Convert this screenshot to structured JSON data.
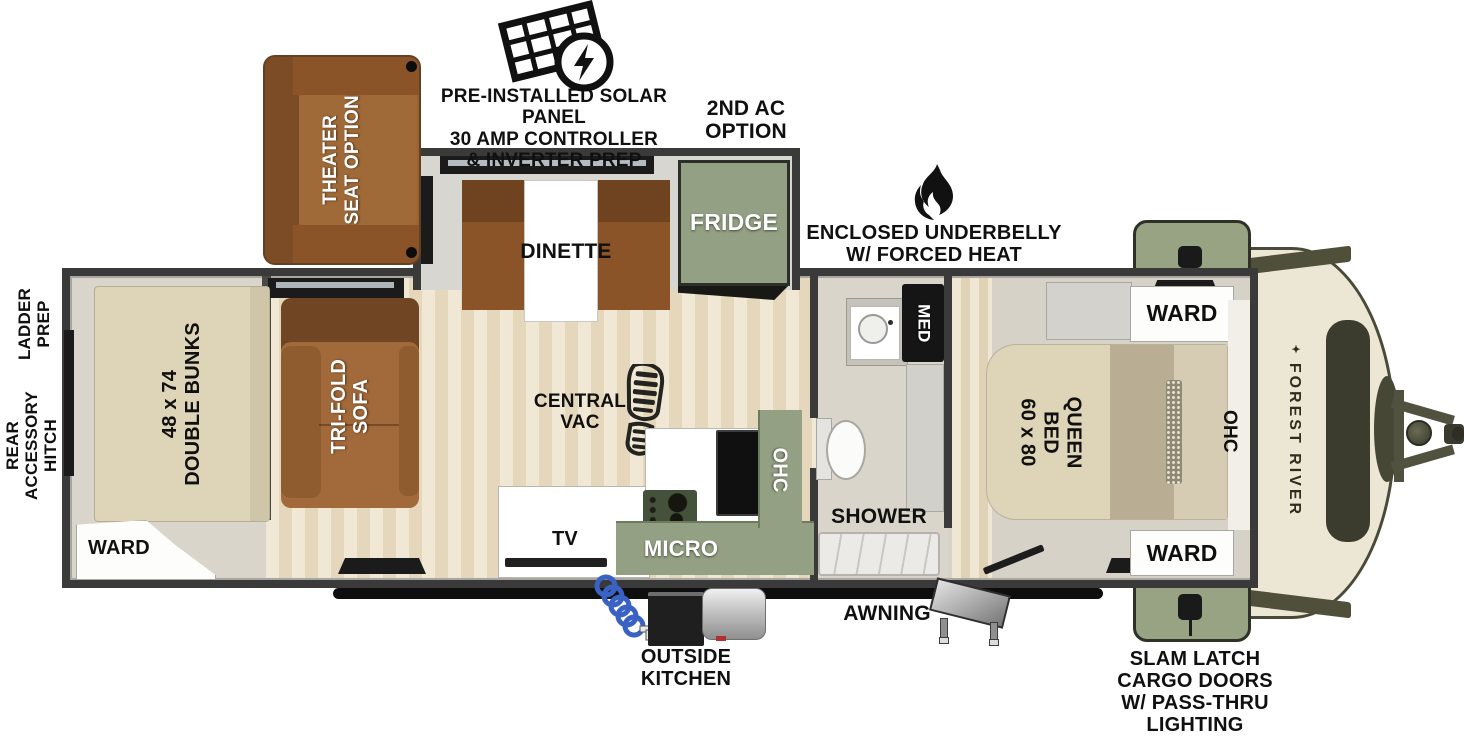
{
  "meta": {
    "title": "Travel trailer floorplan",
    "width": 1464,
    "height": 738
  },
  "colors": {
    "wall": "#3a3a3a",
    "sage_green": "#93a083",
    "sage_dark": "#45523b",
    "sofa_brown": "#a0683a",
    "sofa_dark": "#6f4523",
    "bed_beige": "#ded4b7",
    "bed_olive": "#b9ae93",
    "floor_wood": "#ebdfc4",
    "front_cap_cream": "#ece7d4",
    "olive_trim": "#50503a",
    "hose_blue": "#3a62c4"
  },
  "callouts": {
    "solar": {
      "icon": "solar-panel-icon",
      "lines": [
        "PRE-INSTALLED SOLAR PANEL",
        "30 AMP CONTROLLER",
        "& INVERTER PREP"
      ]
    },
    "second_ac": {
      "lines": [
        "2ND AC",
        "OPTION"
      ]
    },
    "underbelly": {
      "icon": "flame-icon",
      "lines": [
        "ENCLOSED UNDERBELLY",
        "W/ FORCED HEAT"
      ]
    },
    "ladder_prep": {
      "lines": [
        "LADDER",
        "PREP"
      ]
    },
    "rear_accessory_hitch": {
      "lines": [
        "REAR",
        "ACCESSORY",
        "HITCH"
      ]
    },
    "awning": {
      "label": "AWNING"
    },
    "outside_kitchen": {
      "lines": [
        "OUTSIDE",
        "KITCHEN"
      ]
    },
    "slam_latch": {
      "lines": [
        "SLAM LATCH",
        "CARGO DOORS",
        "W/ PASS-THRU",
        "LIGHTING"
      ]
    }
  },
  "options": {
    "theater_seat": {
      "lines": [
        "THEATER",
        "SEAT OPTION"
      ]
    }
  },
  "rooms": {
    "dinette": {
      "label": "DINETTE"
    },
    "fridge": {
      "label": "FRIDGE"
    },
    "bunks": {
      "line1": "48 x 74",
      "line2": "DOUBLE BUNKS"
    },
    "ward_rear": {
      "label": "WARD"
    },
    "tri_fold_sofa": {
      "lines": [
        "TRI-FOLD",
        "SOFA"
      ]
    },
    "central_vac": {
      "lines": [
        "CENTRAL",
        "VAC"
      ],
      "icon": "boot-print-icon"
    },
    "tv": {
      "label": "TV"
    },
    "micro": {
      "label": "MICRO"
    },
    "ohc_kitchen": {
      "label": "OHC"
    },
    "med": {
      "label": "MED"
    },
    "shower": {
      "label": "SHOWER"
    },
    "queen_bed": {
      "line1": "60 x 80",
      "line2": "QUEEN BED"
    },
    "ward_front_top": {
      "label": "WARD"
    },
    "ward_front_bottom": {
      "label": "WARD"
    },
    "ohc_bedroom": {
      "label": "OHC"
    }
  },
  "brand": {
    "front_cap": "FOREST RIVER"
  }
}
